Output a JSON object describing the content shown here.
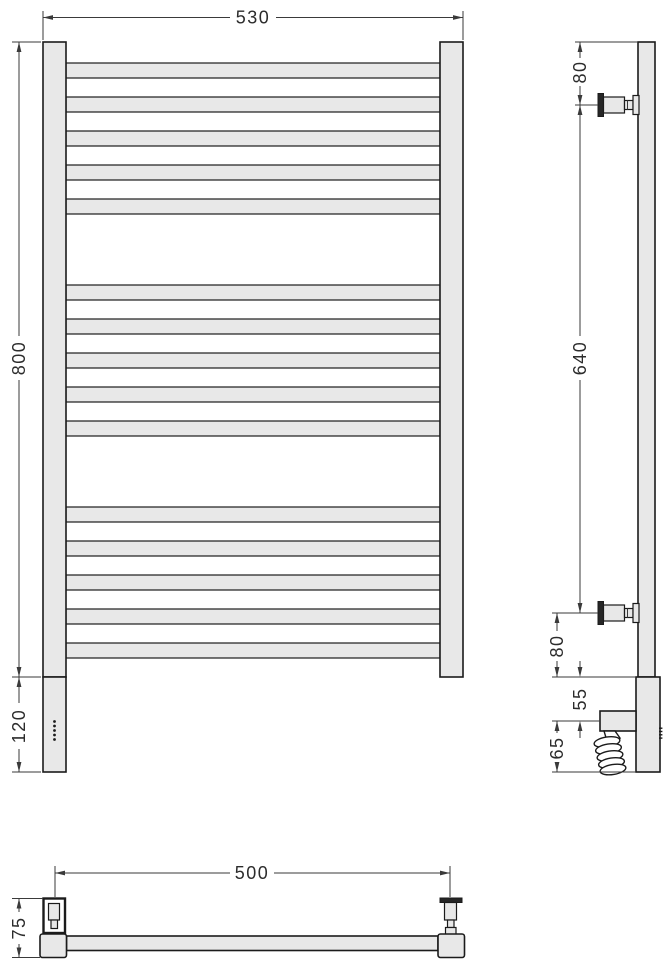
{
  "drawing": {
    "type": "towel-rail-technical-drawing",
    "views": [
      "front",
      "side",
      "plan"
    ]
  },
  "front_view": {
    "width_label": "530",
    "height_label": "800",
    "heater_label": "120",
    "rung_groups": 3,
    "rungs_per_group": 5,
    "indicator_dots": 5
  },
  "side_view": {
    "top_bracket_label": "80",
    "bracket_span_label": "640",
    "bottom_bracket_label": "80",
    "terminal_box_label": "55",
    "cable_label": "65",
    "indicator_dots": 4
  },
  "plan_view": {
    "width_label": "500",
    "depth_label": "75"
  },
  "colors": {
    "fill": "#e8e8e8",
    "line": "#1b1b1b",
    "dim": "#3a3a3a",
    "background": "#ffffff"
  }
}
